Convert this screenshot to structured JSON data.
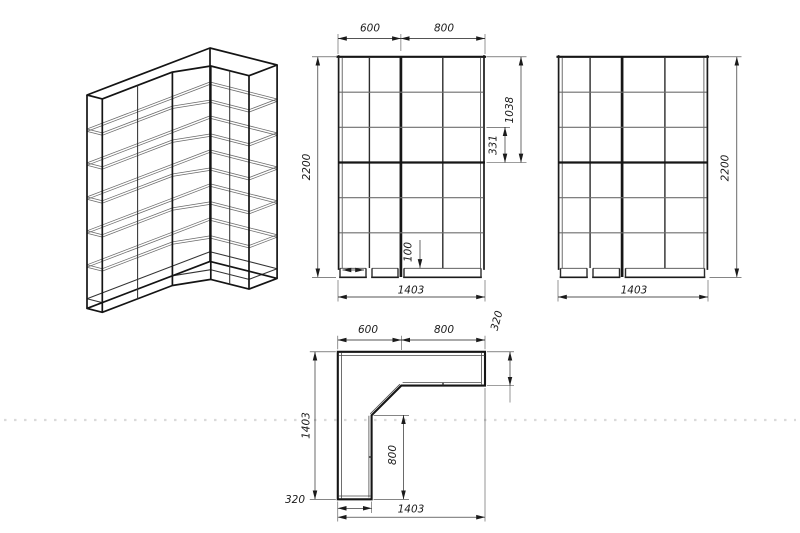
{
  "drawing": {
    "title": "corner-wardrobe-technical-drawing",
    "colors": {
      "line": "#1b1b1b",
      "thin_line": "#6e6e6e",
      "background": "#ffffff"
    },
    "views": {
      "front": {
        "dims": {
          "width_left": "600",
          "width_right": "800",
          "height": "2200",
          "top_section": "1038",
          "shelf_spacing": "331",
          "plinth": "100",
          "total_width": "1403"
        }
      },
      "side": {
        "dims": {
          "height": "2200",
          "total_width": "1403"
        }
      },
      "plan": {
        "dims": {
          "width_left": "600",
          "width_right": "800",
          "depth_right": "320",
          "side_length": "1403",
          "inner_length": "800",
          "depth_left": "320",
          "total_width": "1403"
        }
      }
    }
  }
}
